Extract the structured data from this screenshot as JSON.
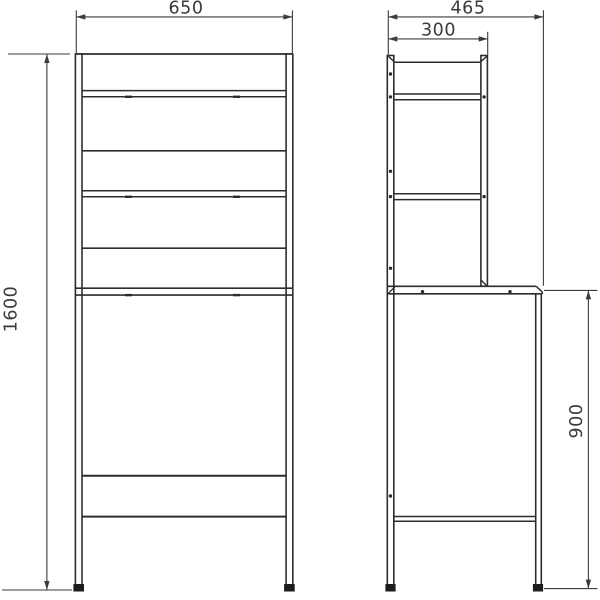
{
  "drawing": {
    "dimensions": {
      "front_width": "650",
      "overall_height": "1600",
      "side_depth": "465",
      "upper_depth": "300",
      "lower_height": "900"
    },
    "colors": {
      "background": "#ffffff",
      "line": "#2d2d2d",
      "dimension_line": "#3c3c3c",
      "text": "#3a3a3a",
      "feet": "#1c1c1c"
    }
  }
}
